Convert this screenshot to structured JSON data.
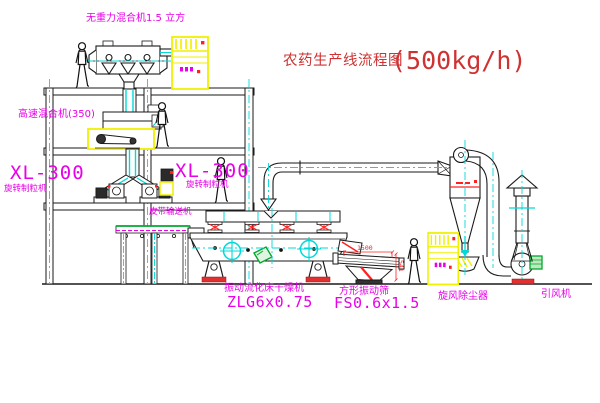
{
  "title": {
    "text": "农药生产线流程图",
    "capacity": "(500kg/h)"
  },
  "labels": {
    "gravity_mixer": "无重力混合机1.5 立方",
    "high_speed_mixer": "高速混合机(350)",
    "granulator_left_model": "XL-300",
    "granulator_left_name": "旋转制粒机",
    "granulator_center_model": "XL-300",
    "granulator_center_name": "旋转制粒机",
    "belt_conveyor": "皮带输送机",
    "dryer_name": "振动流化床干燥机",
    "dryer_model": "ZLG6x0.75",
    "sieve_name": "方形振动筛",
    "sieve_model": "FS0.6x1.5",
    "cyclone": "旋风除尘器",
    "fan": "引风机"
  },
  "dimensions": {
    "sieve_length": "1500",
    "sieve_height": "541"
  },
  "colors": {
    "annotation": "#e800e8",
    "title": "#cf3232",
    "centerline": "#00d9d9",
    "outline": "#1a1a1a",
    "highlight": "#f0f000",
    "accent_red": "#ff2020",
    "accent_green": "#00a82d"
  }
}
